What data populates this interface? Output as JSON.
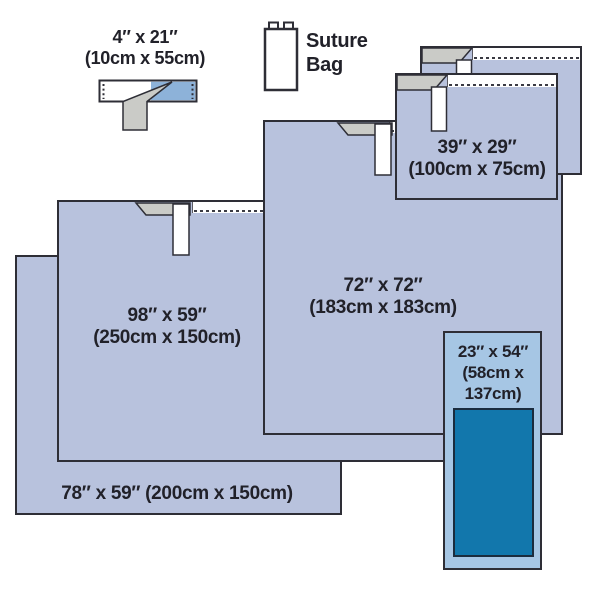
{
  "colors": {
    "drape_fill": "#b8c2dd",
    "drape_border": "#2e2e36",
    "light_blue_drape_fill": "#a6c6e4",
    "dark_blue_panel": "#1277ac",
    "tape_strip_blue": "#8db2d9",
    "fold_gray": "#cacbc7",
    "text": "#212129",
    "background": "#ffffff"
  },
  "items": {
    "tape_drape": {
      "line1": "4″ x 21″",
      "line2": "(10cm x 55cm)"
    },
    "suture_bag": {
      "line1": "Suture",
      "line2": "Bag"
    },
    "drape_39x29": {
      "line1": "39″ x 29″",
      "line2": "(100cm x 75cm)"
    },
    "drape_72x72": {
      "line1": "72″ x 72″",
      "line2": "(183cm x 183cm)"
    },
    "drape_98x59": {
      "line1": "98″ x 59″",
      "line2": "(250cm x 150cm)"
    },
    "drape_78x59": {
      "label": "78″ x 59″ (200cm x 150cm)"
    },
    "drape_23x54": {
      "line1": "23″ x 54″",
      "line2": "(58cm x",
      "line3": "137cm)"
    }
  }
}
